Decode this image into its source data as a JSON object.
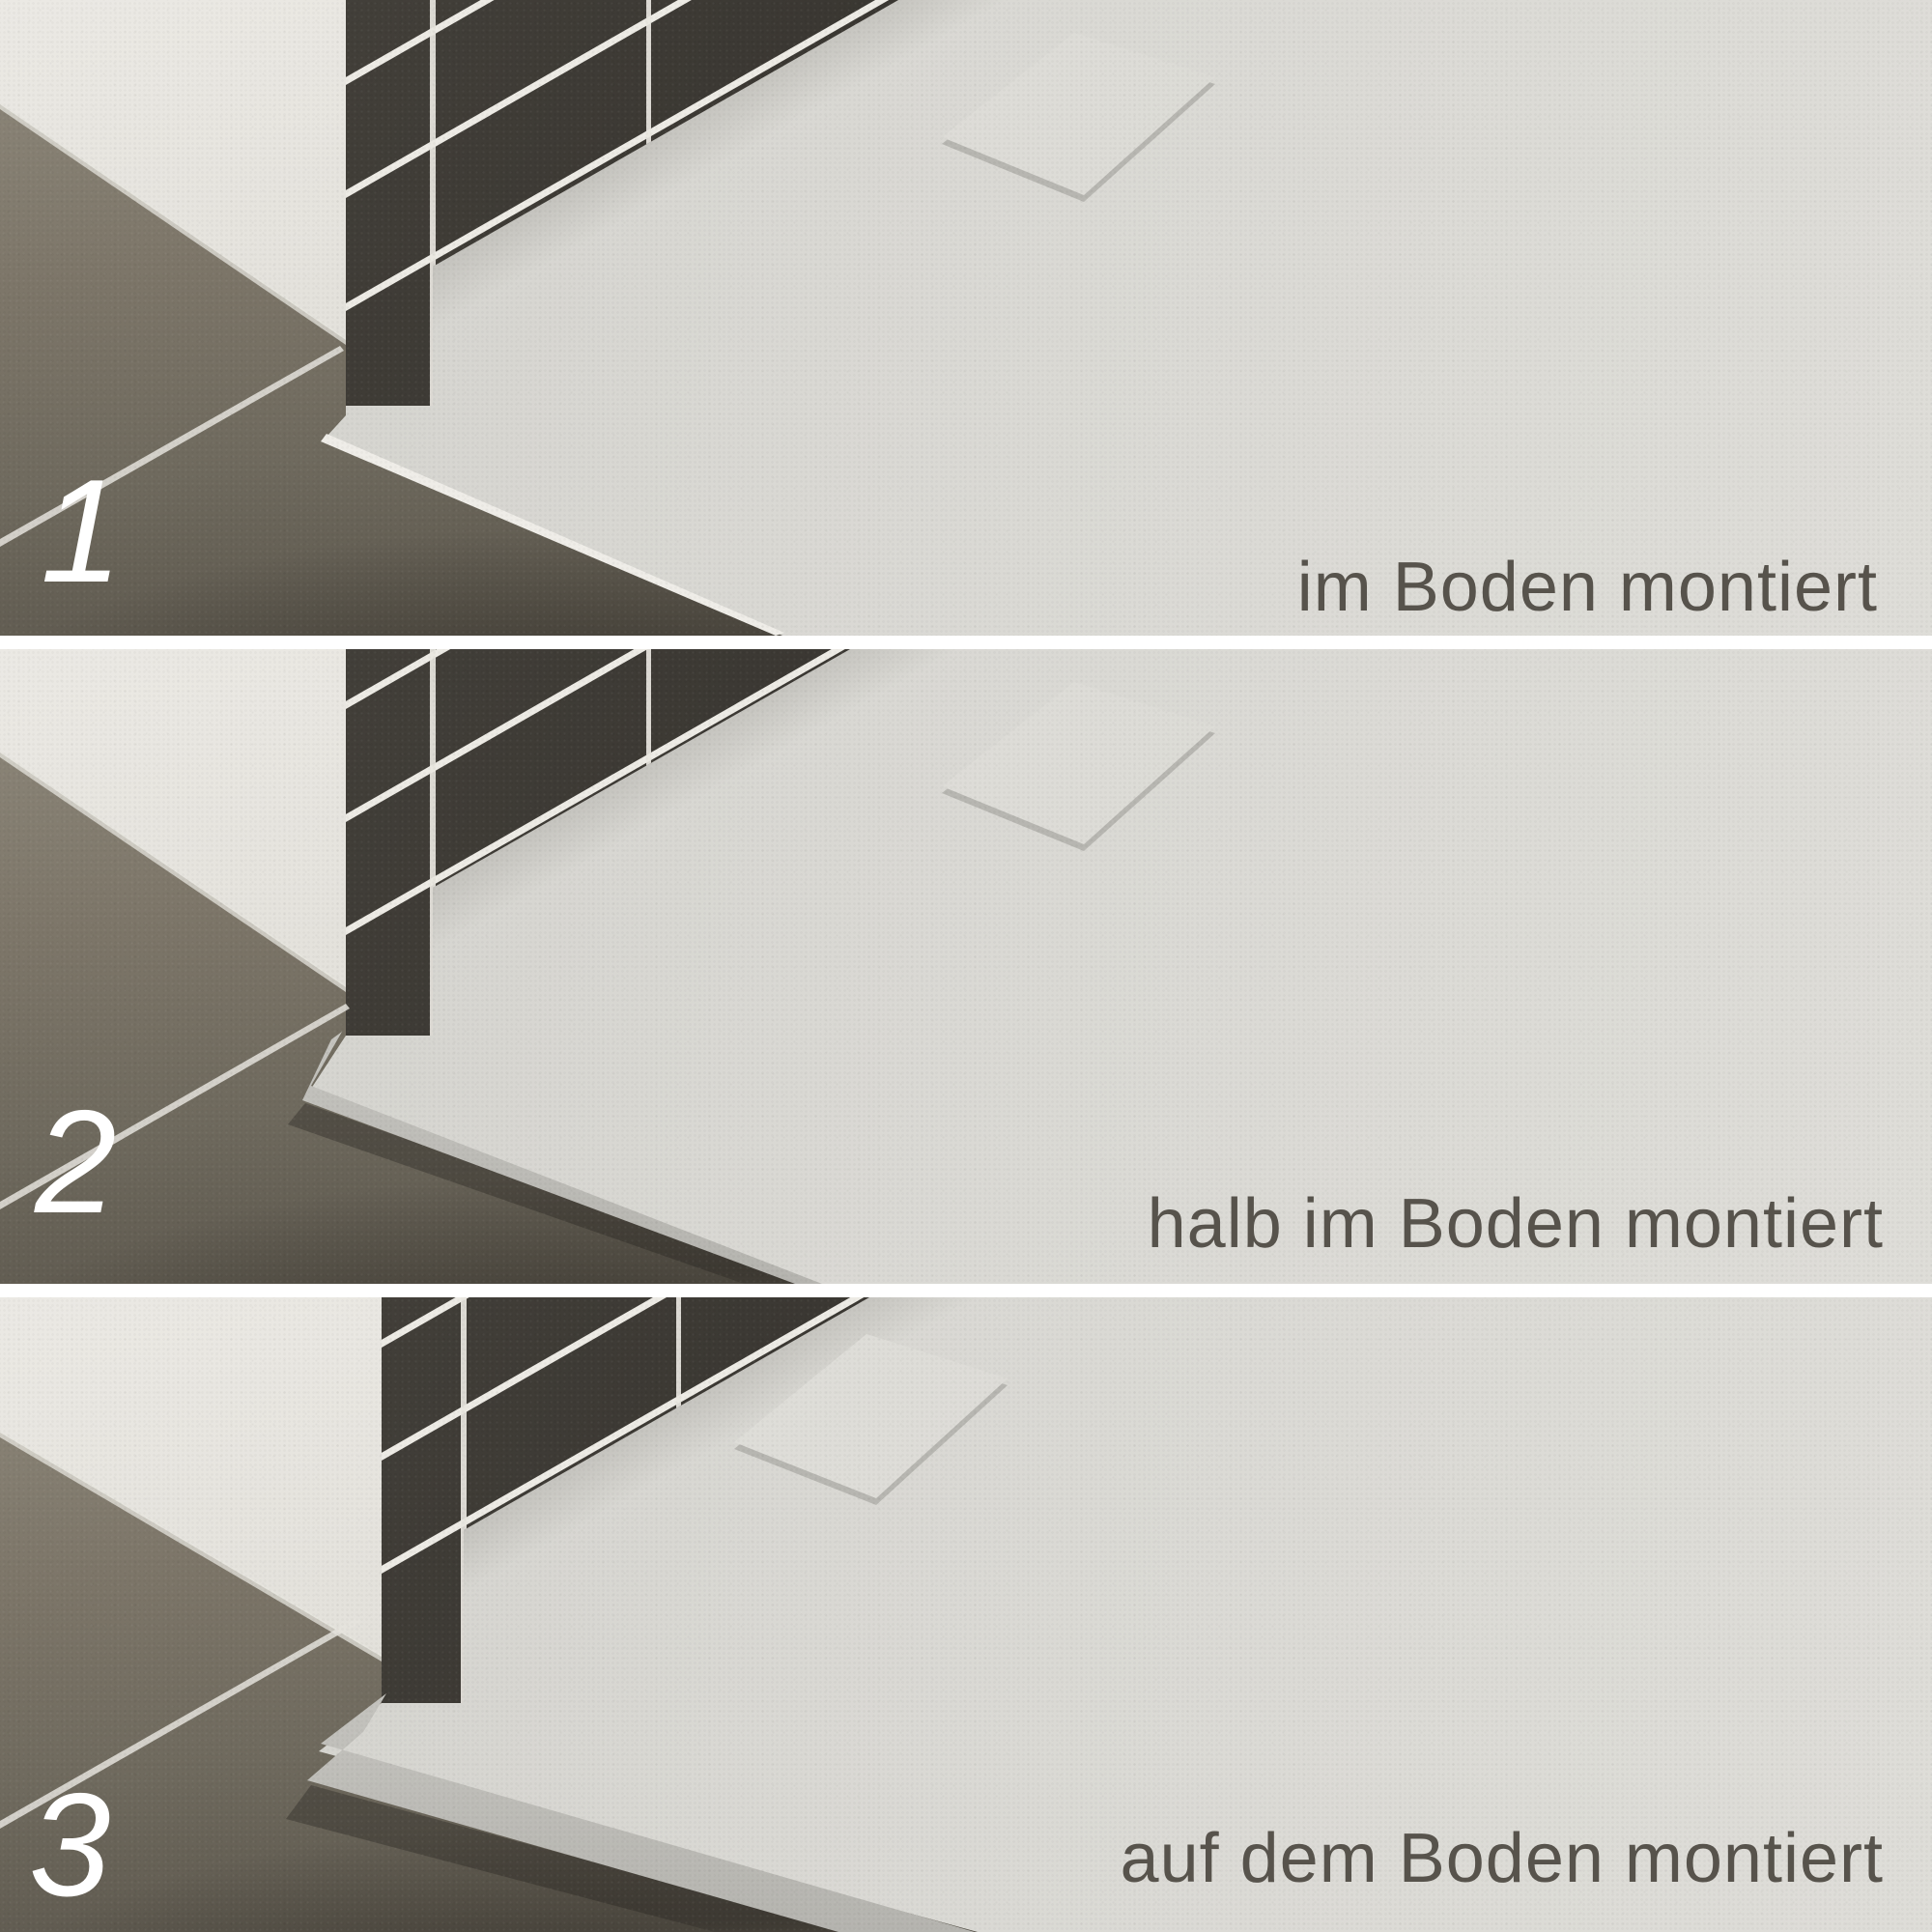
{
  "title": "Duschwanne Montageoptionen",
  "panels": [
    {
      "number": "1",
      "label": "im Boden montiert"
    },
    {
      "number": "2",
      "label": "halb im Boden montiert"
    },
    {
      "number": "3",
      "label": "auf dem Boden montiert"
    }
  ],
  "colors": {
    "tray_surface": "#d9d8d3",
    "wall_white": "#e3e1db",
    "wall_tiles_dark": "#37342f",
    "grout_white": "#edebe5",
    "floor_tiles": "#7d7669",
    "floor_shadow": "#474339",
    "label_text": "#57534c",
    "number_text": "#ffffff",
    "panel_gap": "#ffffff"
  }
}
